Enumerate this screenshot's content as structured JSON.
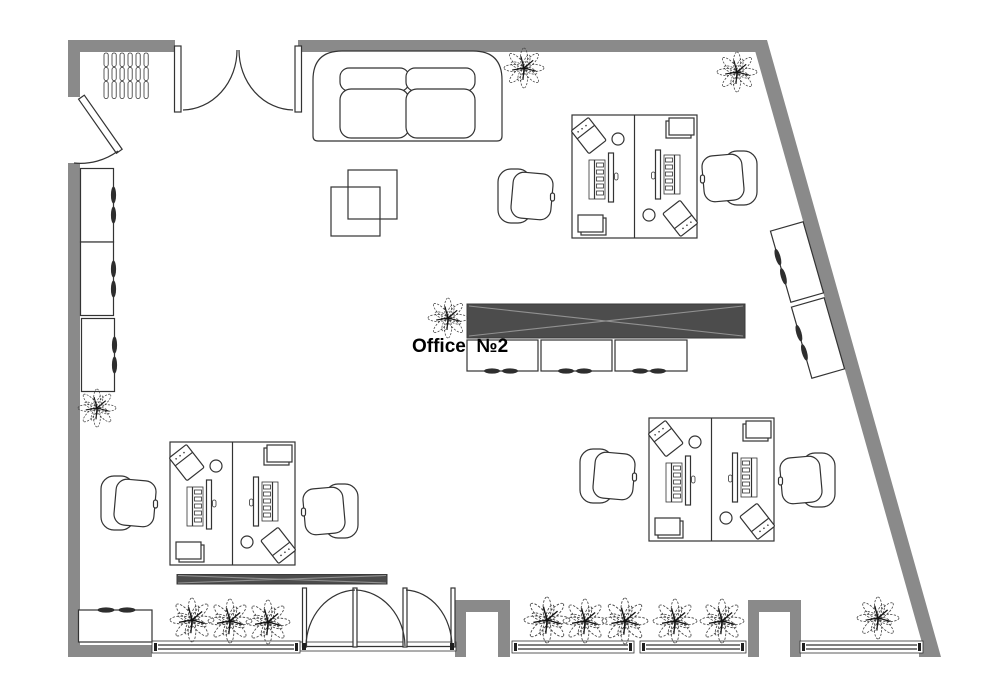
{
  "page": {
    "title": "Office floor plan"
  },
  "room": {
    "label": "Office  №2"
  },
  "colors": {
    "wall": "#8a8a8a",
    "outline": "#333333",
    "dark": "#4c4c4c",
    "dark-edge": "#3a3a3a",
    "cross": "#919191"
  },
  "inventory": {
    "workstation_clusters": 3,
    "desks": 6,
    "office_chairs": 6,
    "sofas": 1,
    "coffee_tables": 2,
    "left_wall_cabinets": 3,
    "right_wall_cabinets": 2,
    "center_low_cabinets": 3,
    "bottom_left_cabinet": 1,
    "coat_rack_slats": 6,
    "plants": 13,
    "windows": 4,
    "door_openings": 4
  }
}
